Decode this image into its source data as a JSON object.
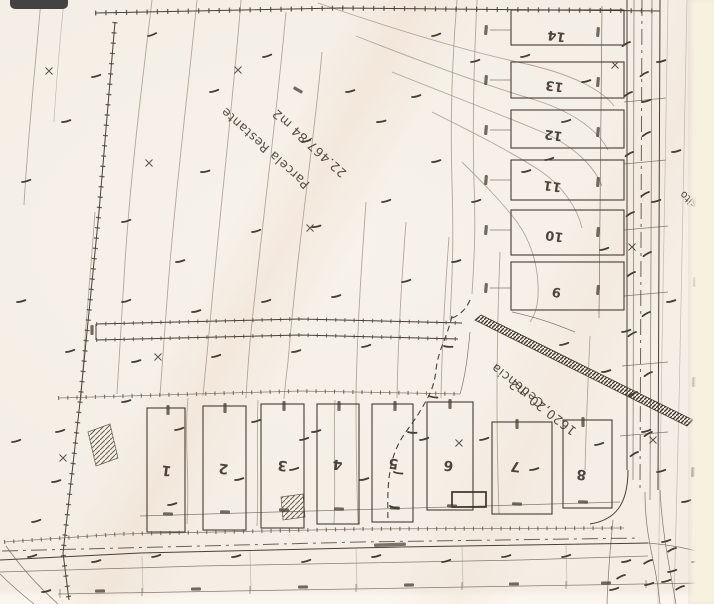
{
  "labels": {
    "parcela_restante": "Parcela Restante",
    "parcela_restante_area": "22.467,84 m2",
    "cedencia": "Cedencia",
    "cedencia_area": "1620,20 m2",
    "edge_word_top": "Via",
    "edge_word_bottom": "Deposito"
  },
  "bottom_lots": [
    {
      "num": "1"
    },
    {
      "num": "2"
    },
    {
      "num": "3"
    },
    {
      "num": "4"
    },
    {
      "num": "5"
    },
    {
      "num": "6"
    },
    {
      "num": "7"
    },
    {
      "num": "8"
    }
  ],
  "right_lots": [
    {
      "num": "14"
    },
    {
      "num": "13"
    },
    {
      "num": "12"
    },
    {
      "num": "11"
    },
    {
      "num": "10"
    },
    {
      "num": "9"
    }
  ],
  "colors": {
    "paper": "#f4eee5",
    "ink": "#453b30",
    "paper_edge_strip": "#f7f2df",
    "overlay_pill": "#454243"
  }
}
